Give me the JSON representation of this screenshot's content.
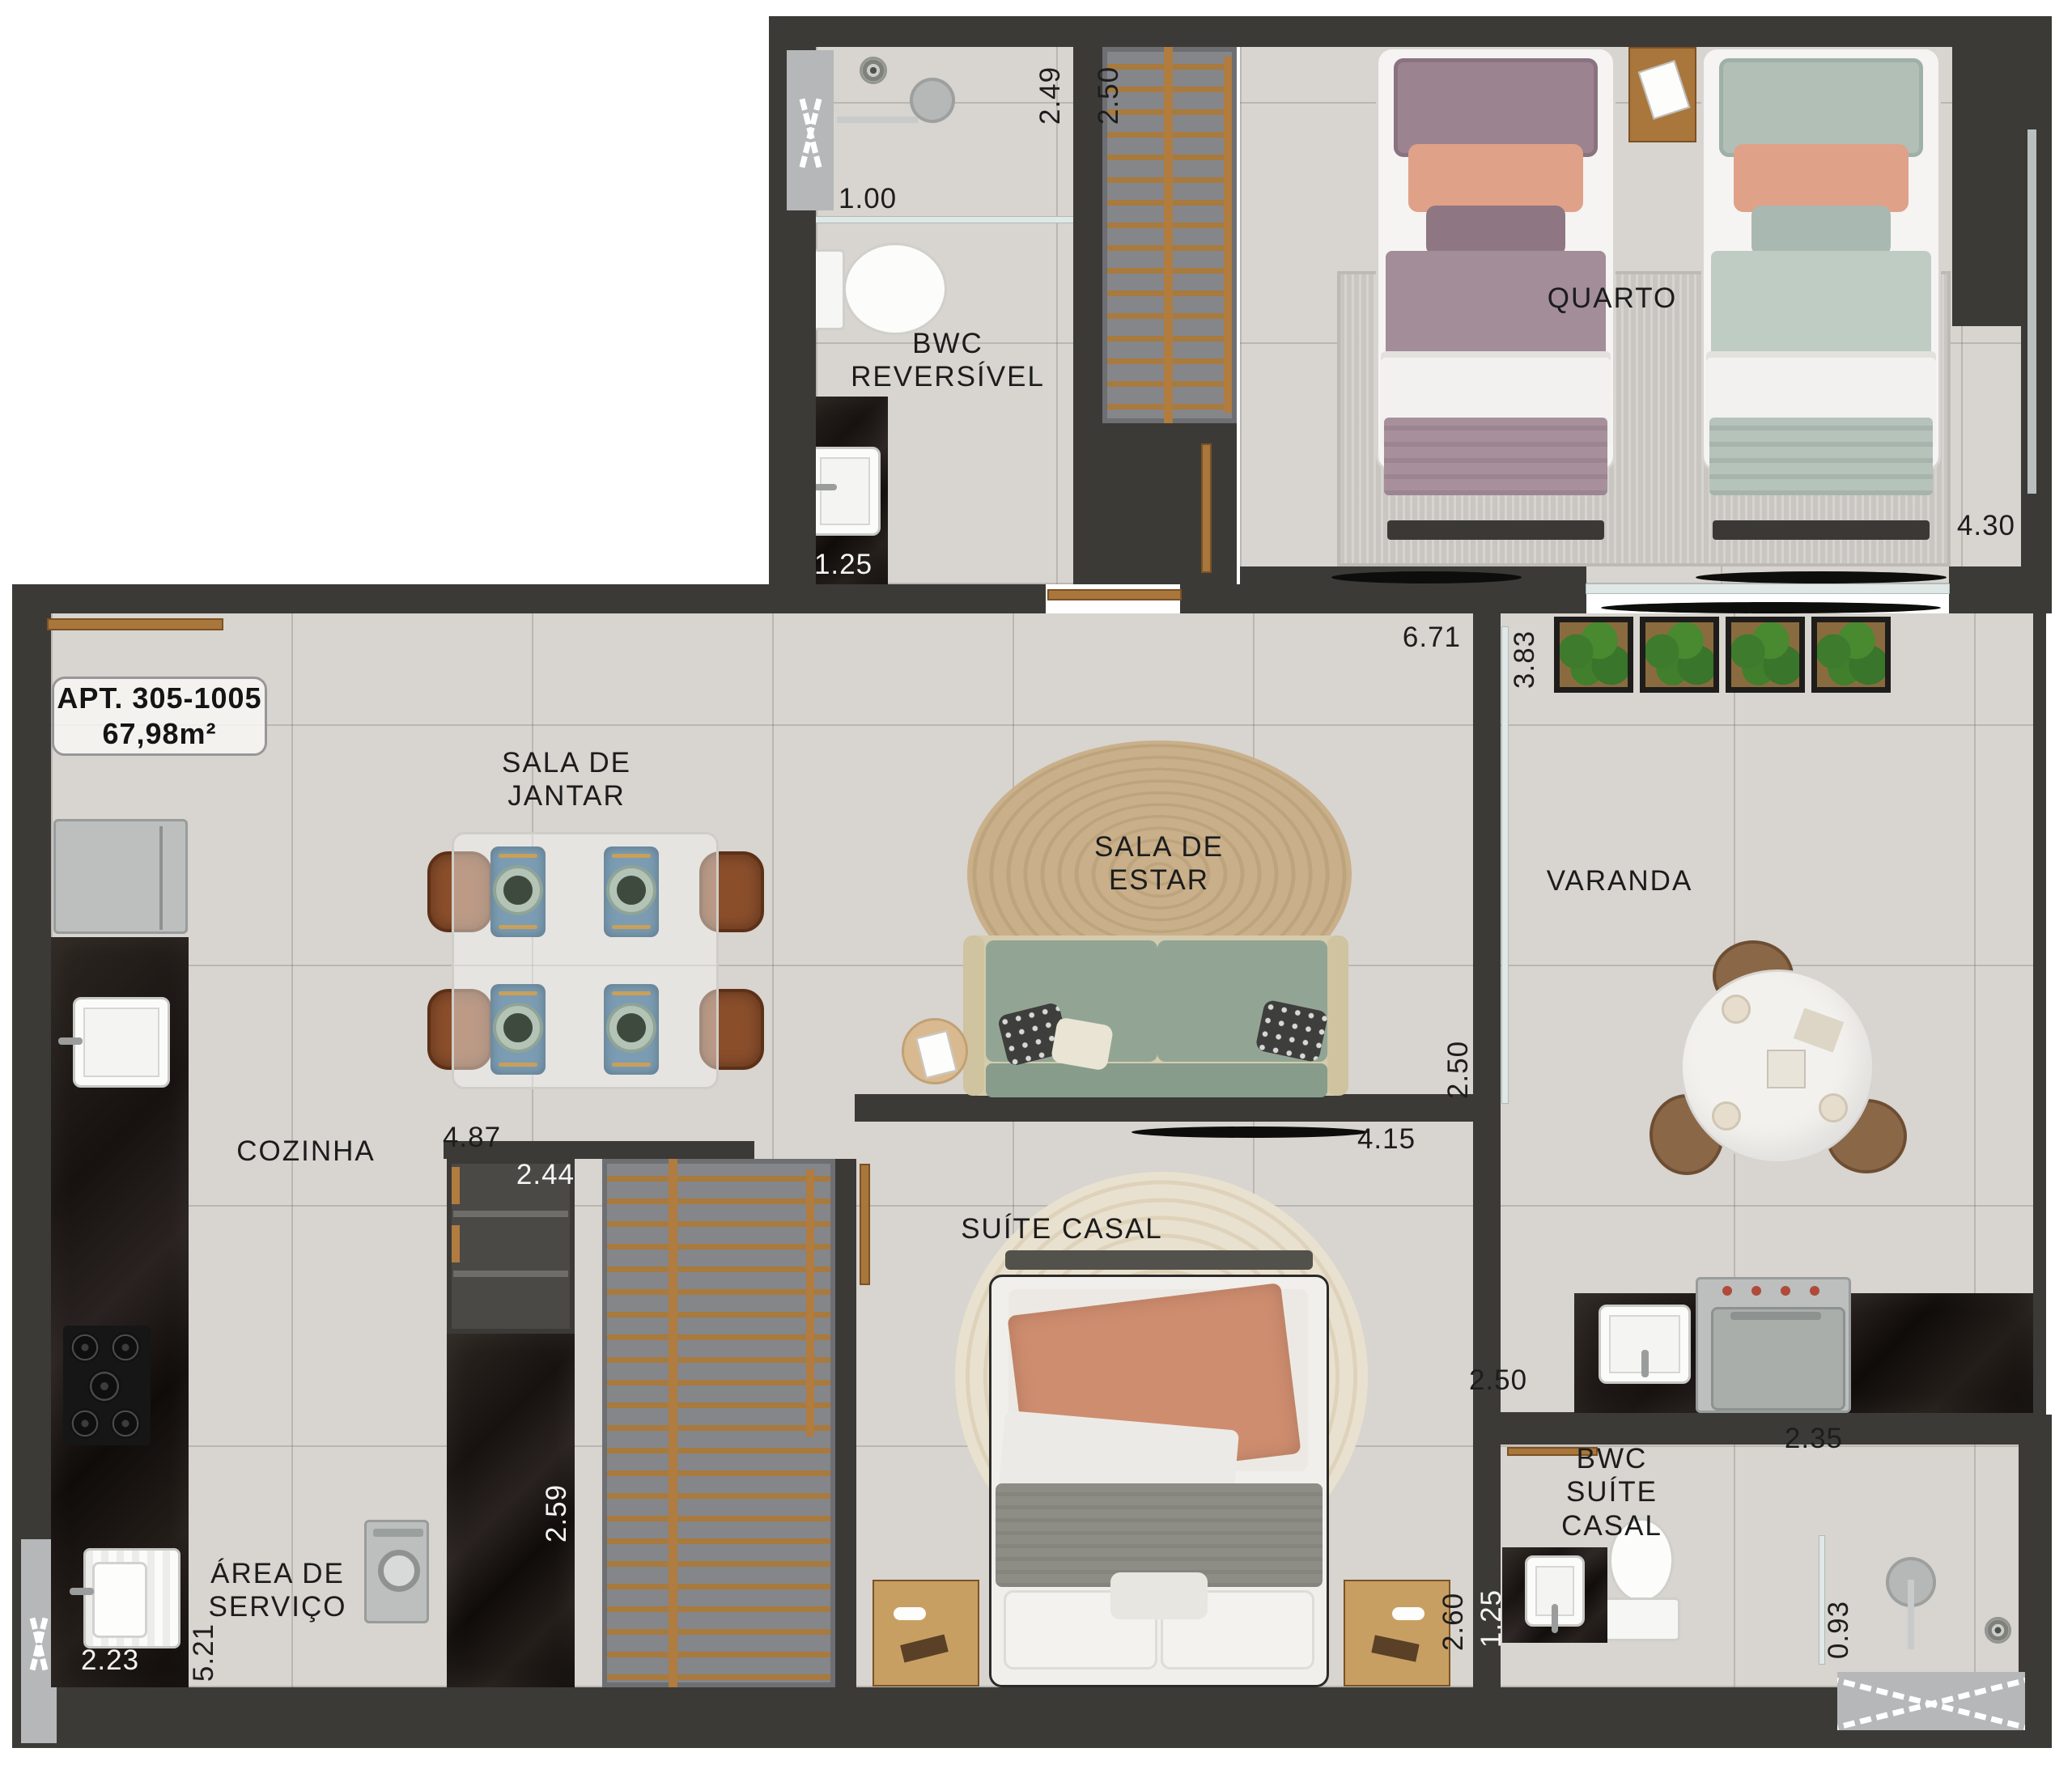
{
  "apartment_badge": {
    "line1": "APT. 305-1005",
    "line2": "67,98m²"
  },
  "rooms": {
    "bwc_reversivel": {
      "l1": "BWC",
      "l2": "REVERSÍVEL"
    },
    "quarto": {
      "l1": "QUARTO"
    },
    "sala_jantar": {
      "l1": "SALA DE",
      "l2": "JANTAR"
    },
    "sala_estar": {
      "l1": "SALA DE",
      "l2": "ESTAR"
    },
    "varanda": {
      "l1": "VARANDA"
    },
    "cozinha": {
      "l1": "COZINHA"
    },
    "area_servico": {
      "l1": "ÁREA DE",
      "l2": "SERVIÇO"
    },
    "suite_casal": {
      "l1": "SUÍTE CASAL"
    },
    "bwc_suite": {
      "l1": "BWC",
      "l2": "SUÍTE",
      "l3": "CASAL"
    }
  },
  "dimensions": {
    "bwc_width": "2.49",
    "closet_width": "2.50",
    "shower_width": "1.00",
    "bwc_vanity": "1.25",
    "quarto_width": "4.30",
    "sala_length": "6.71",
    "varanda_width": "3.83",
    "sala_width": "2.50",
    "sala_depth": "4.15",
    "jantar_length": "4.87",
    "cabinet_width": "2.44",
    "cabinet_depth": "2.59",
    "tanque_width": "2.23",
    "servico_length": "5.21",
    "varanda_counter": "2.50",
    "bwc_suite_width": "2.35",
    "suite_shower": "0.93",
    "suite_vanity": "1.25",
    "suite_width": "2.60"
  },
  "colors": {
    "wall": "#3b3a37",
    "floor": "#d8d4cf",
    "marble_counter": "#1d1713",
    "wood_door": "#a9763c",
    "closet_niche": "#87898b",
    "sofa_green": "#92a595",
    "bed_mauve": "#9c8390",
    "bed_sage": "#b2bfb7",
    "accent_salmon": "#e0a189",
    "throw_terracotta": "#cf8d6f",
    "jute_rug": "#c9b08b",
    "chair_leather": "#8a4e2b",
    "placemat_blue": "#7b9cb3",
    "plant_green": "#49892f",
    "label_text": "#1c1c1c",
    "dim_text_light": "#f4f4f2"
  },
  "icons": [
    "entry-door-icon",
    "window-hatch-icon",
    "shower-head-icon",
    "floor-drain-icon",
    "toilet-icon",
    "sink-icon",
    "fridge-icon",
    "cooktop-icon",
    "laundry-tub-icon",
    "washing-machine-icon",
    "grill-icon",
    "wardrobe-rack-icon",
    "sofa-icon",
    "tv-icon",
    "dining-table-icon",
    "chair-icon",
    "round-table-icon",
    "nightstand-icon",
    "planter-icon",
    "rug-icon",
    "sliding-door-icon",
    "towel-bar-icon"
  ]
}
